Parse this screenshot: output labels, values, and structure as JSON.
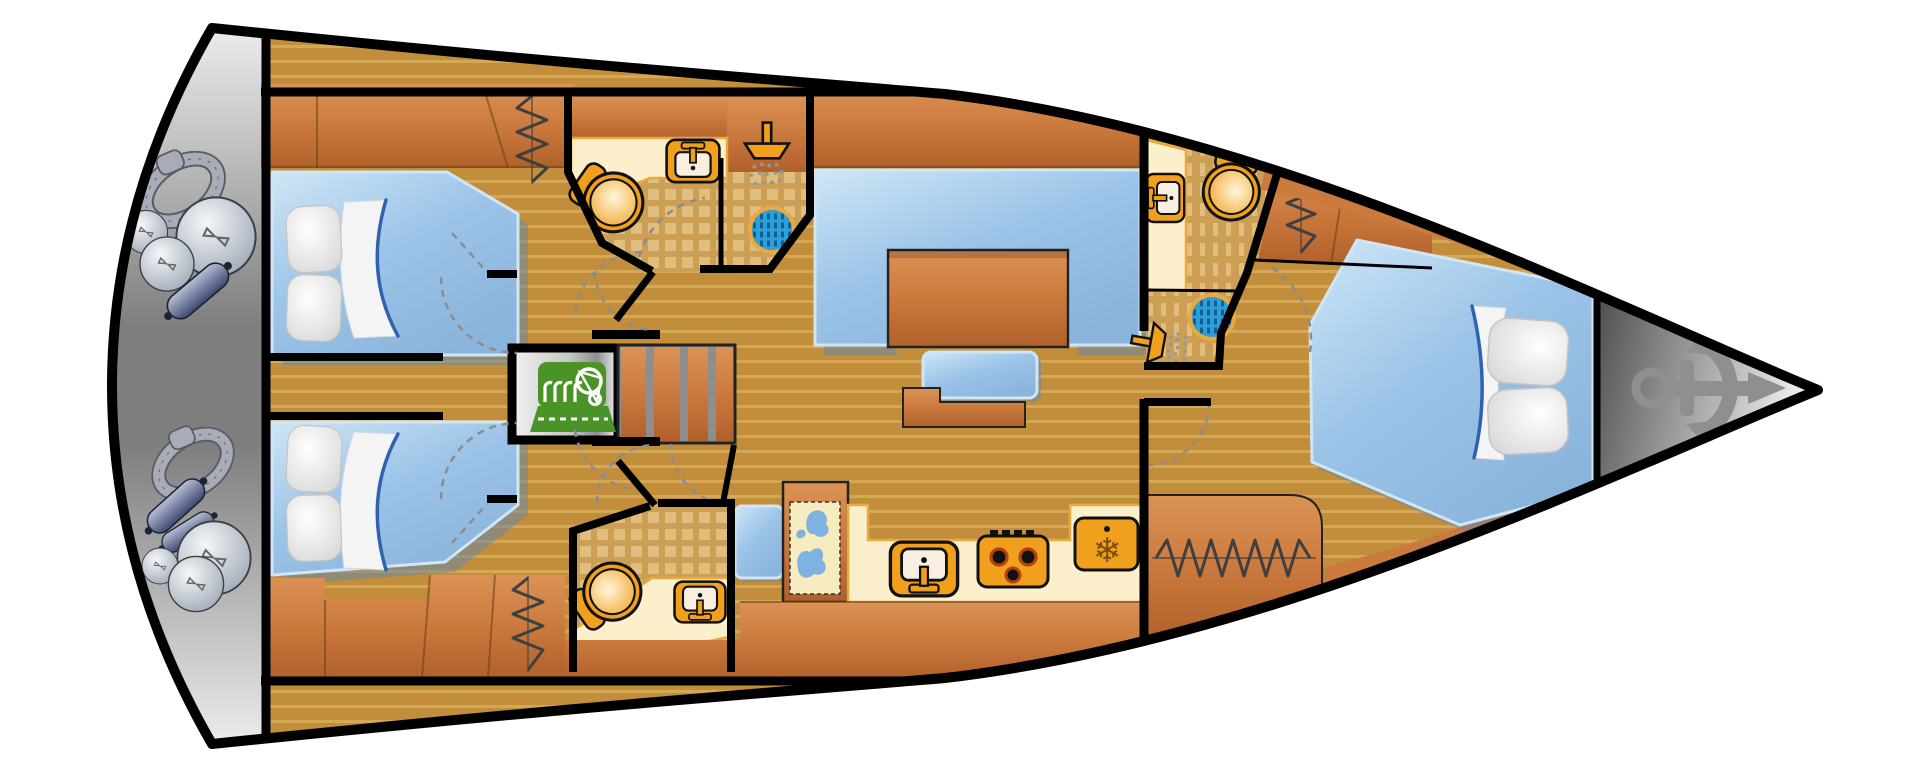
{
  "meta": {
    "type": "sailing-yacht-interior-floor-plan",
    "view": "top-down",
    "orientation": {
      "stern": "left",
      "bow": "right"
    }
  },
  "glyphs": {
    "snowflake": "❄"
  },
  "rooms": {
    "stern_locker": {
      "label": "Stern locker with mooring ropes and fenders"
    },
    "aft_cabin_port": {
      "label": "Aft double cabin, port side"
    },
    "aft_cabin_starboard": {
      "label": "Aft double cabin, starboard side"
    },
    "head_port": {
      "label": "Aft head with washbasin, toilet and shower"
    },
    "head_starboard": {
      "label": "Aft head with toilet and washbasin"
    },
    "engine_room": {
      "label": "Engine compartment"
    },
    "companionway": {
      "label": "Companionway steps"
    },
    "salon": {
      "label": "Salon with U-shaped settee and table"
    },
    "galley": {
      "label": "Galley with sink, stove and refrigerator"
    },
    "nav_station": {
      "label": "Navigation station with chart table and seat"
    },
    "forward_head": {
      "label": "Forward head with toilet, washbasin and shower"
    },
    "forward_cabin": {
      "label": "Forward V-berth double cabin"
    },
    "bow_locker": {
      "label": "Bow anchor locker"
    }
  },
  "fixtures": [
    "toilet",
    "washbasin-sink",
    "shower-head",
    "shower-drain",
    "stove-3-burner",
    "refrigerator",
    "engine",
    "companionway-steps",
    "hanging-locker",
    "chart-map",
    "double-bed",
    "pillows",
    "mooring-rope-coil",
    "fender-ball",
    "fender-cylinder",
    "anchor"
  ],
  "colors": {
    "outline": "#000000",
    "deck": "#ffffff",
    "floor_base": "#C28E3C",
    "floor_stripe": "#D5A855",
    "tile_base": "#CC9F55",
    "tile_square": "#DFBE80",
    "wood_base": "#CB7A3E",
    "wood_light": "#DC9255",
    "wood_dark": "#B0602A",
    "bed_blue": "#9CC4E8",
    "bed_blue_light": "#CFE6F6",
    "bed_shadow": "#5F85AD",
    "counter_cream": "#FBF0CB",
    "counter_edge": "#E9A93F",
    "fixture_orange": "#F0A01C",
    "drain_blue": "#2CA0DB",
    "drain_dash": "#155E92",
    "engine_green": "#4A9427",
    "stern_gray_light": "#EFEFEF",
    "stern_gray_dark": "#7E7E7E",
    "bow_gray_light": "#F0F0F0",
    "bow_gray_dark": "#4A4A4A",
    "anchor_gray": "#8F8F8F",
    "fender_dark": "#96A0AE",
    "rope_gray": "#A7ACB6",
    "zigzag": "#3F3F3F",
    "dash_gray": "#8C8C8C",
    "map_cream": "#F7EBC0",
    "map_blue": "#7FB2E0"
  }
}
